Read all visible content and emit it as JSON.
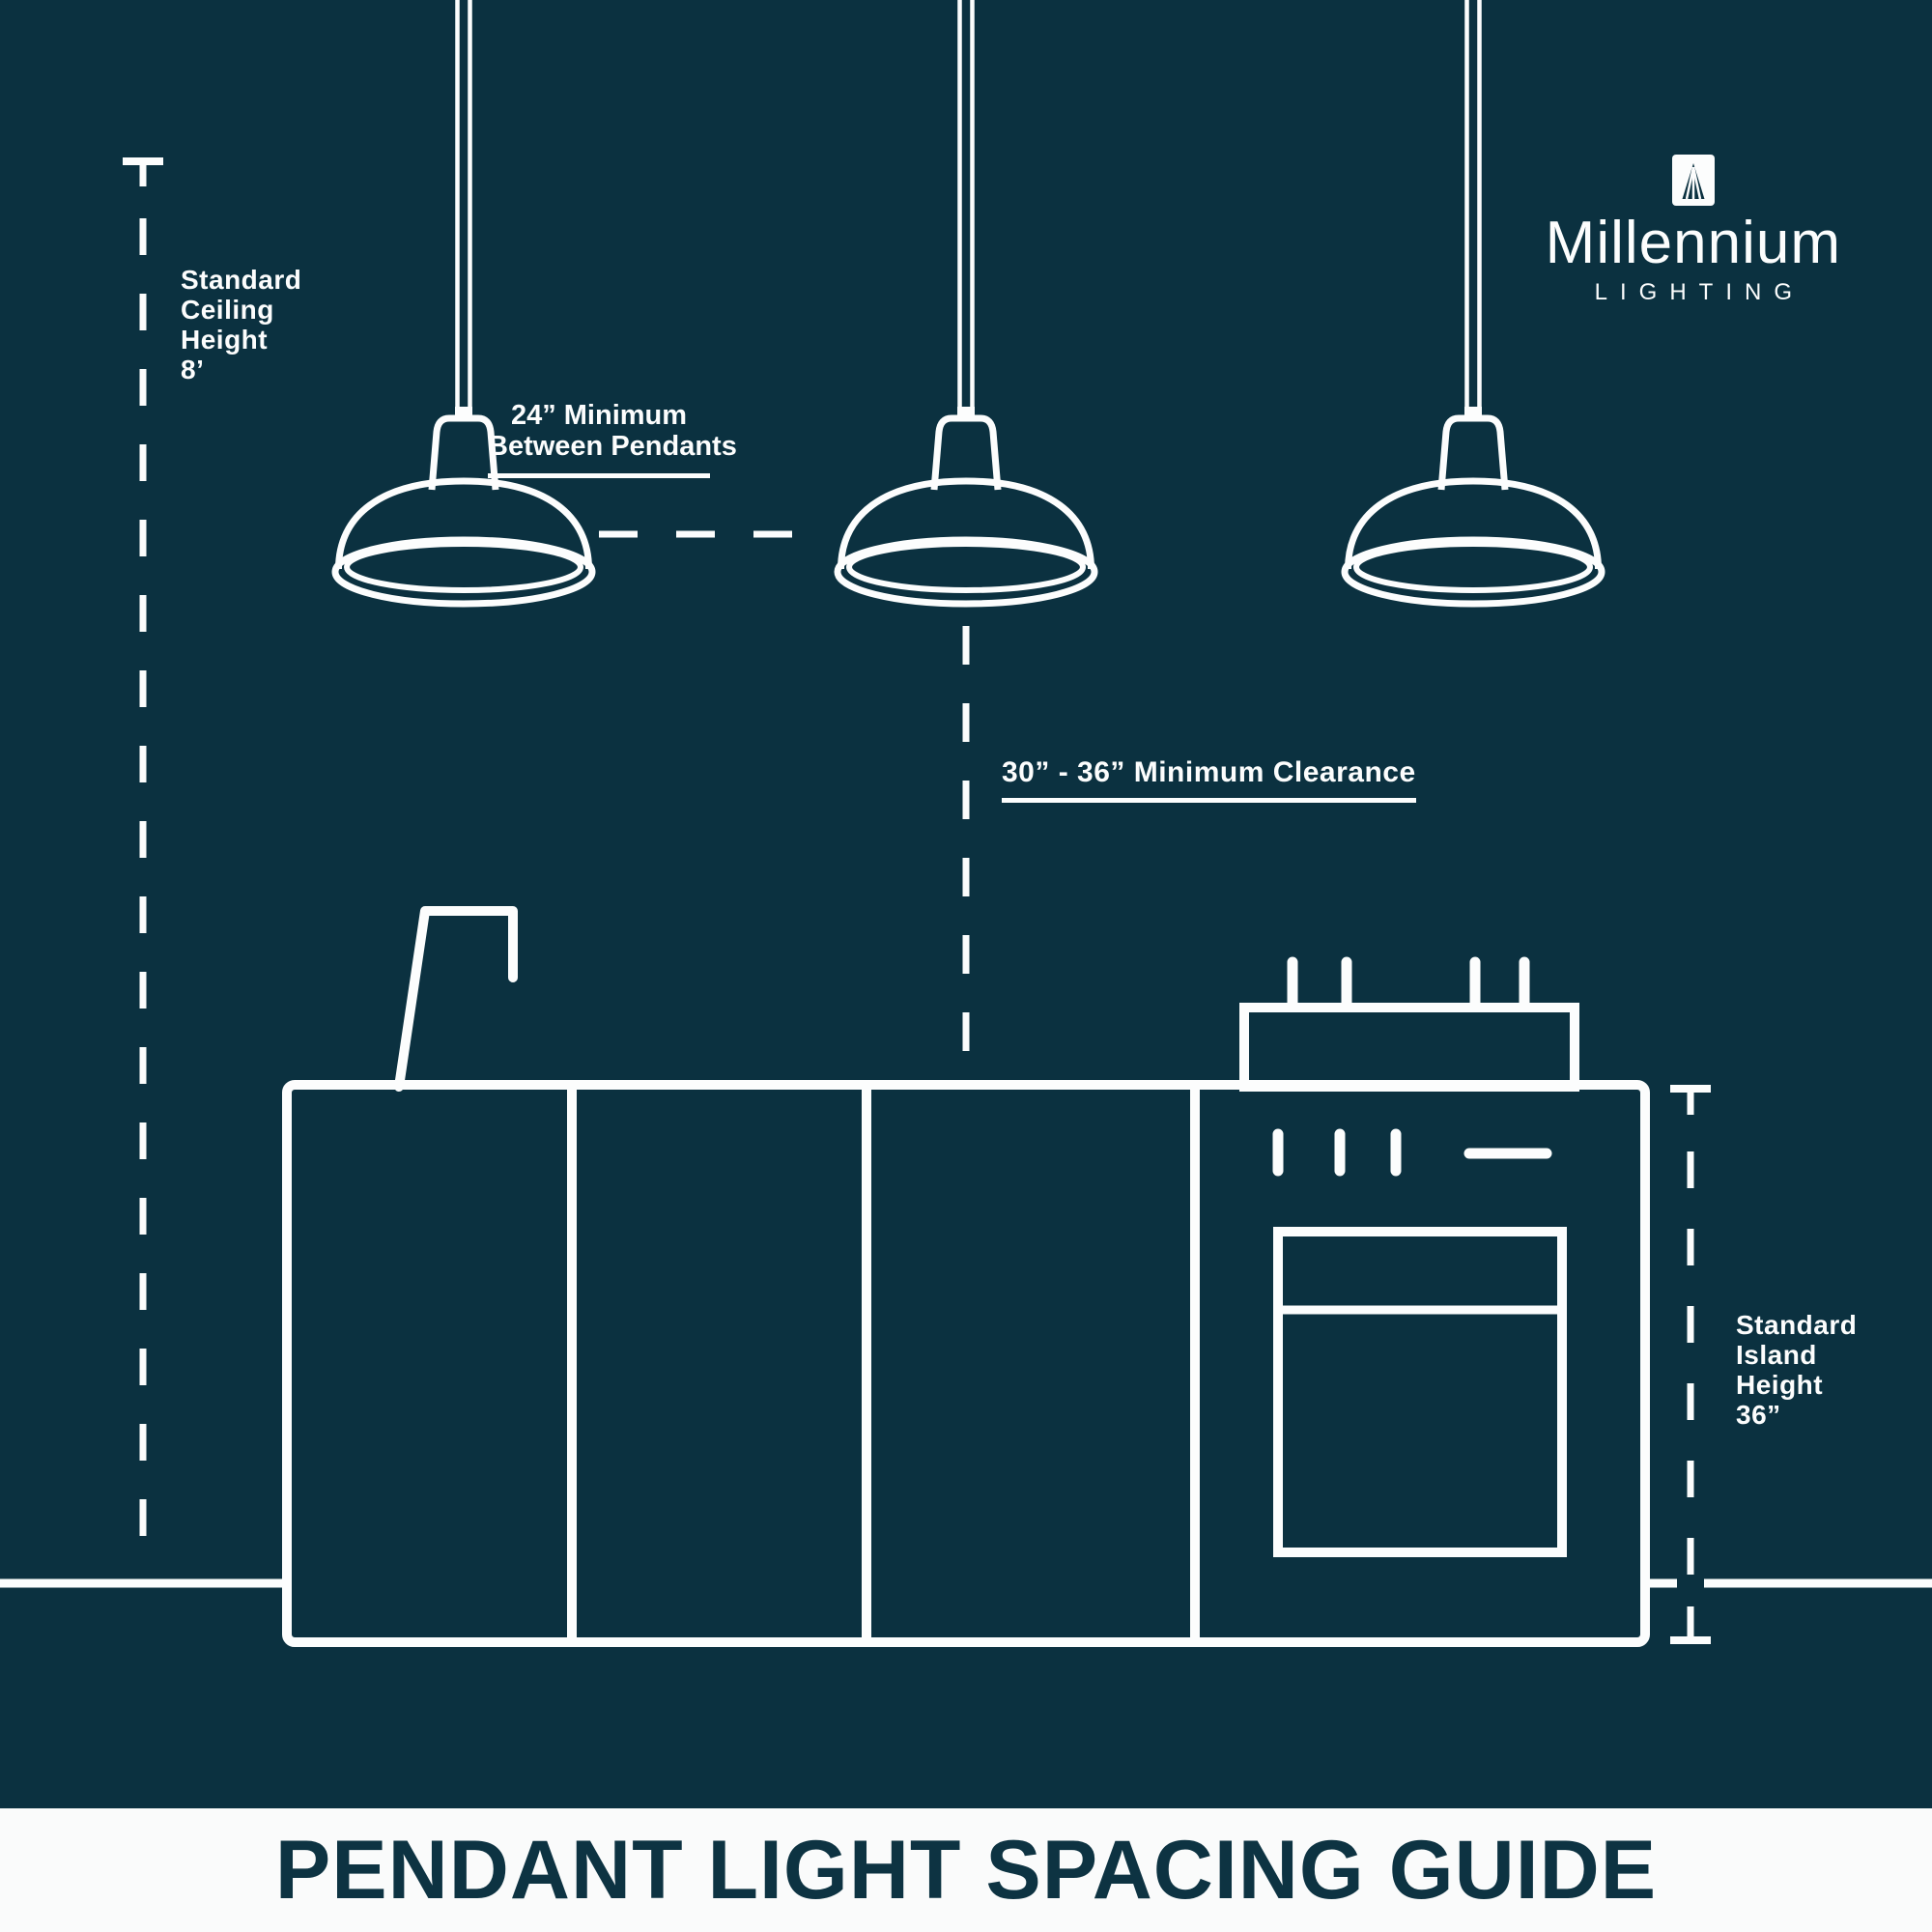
{
  "colors": {
    "background": "#0b3140",
    "line": "#fcfdfd",
    "footer_background": "#fafbfb",
    "footer_text": "#0d3342"
  },
  "brand": {
    "name": "Millennium",
    "subtitle": "LIGHTING"
  },
  "labels": {
    "ceiling_height": {
      "lines": [
        "Standard",
        "Ceiling",
        "Height",
        "8’"
      ]
    },
    "pendant_spacing": {
      "lines": [
        "24” Minimum",
        "Between Pendants"
      ]
    },
    "clearance": {
      "text": "30” - 36” Minimum Clearance"
    },
    "island_height": {
      "lines": [
        "Standard",
        "Island",
        "Height",
        "36”"
      ]
    }
  },
  "footer": {
    "title": "PENDANT LIGHT SPACING GUIDE"
  },
  "diagram": {
    "pendant_count": 3,
    "measurements": {
      "ceiling_height": "8’",
      "min_between_pendants": "24”",
      "min_clearance": "30” - 36”",
      "island_height": "36”"
    }
  }
}
